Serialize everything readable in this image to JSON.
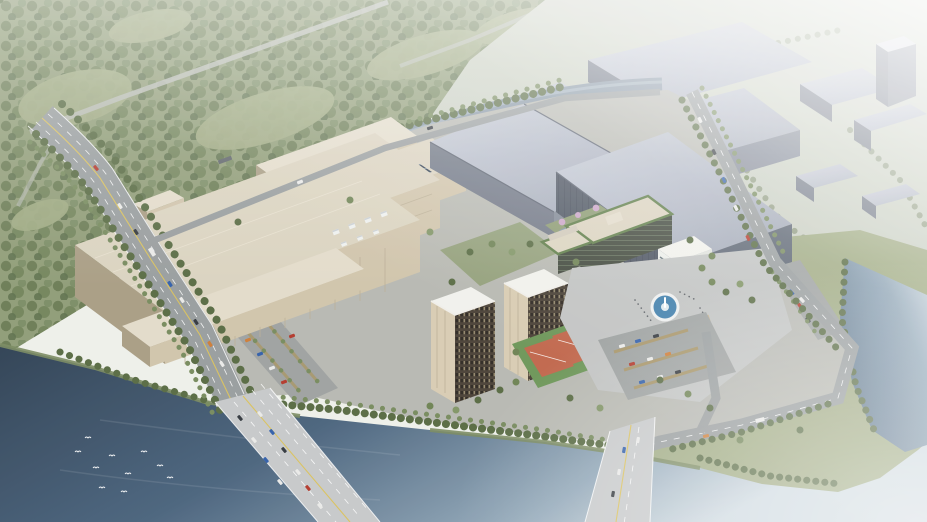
{
  "scene": {
    "type": "architectural-aerial-rendering",
    "description": "Bird's-eye daytime rendering of a riverside industrial / R&D campus: large beige fab halls with rooftop cooling units and solar panels, gray logistics warehouses, two brown dormitory towers, offices with green roof trim, a circular fountain plaza, basketball courts, tree-lined boulevard crossing a dark river on a wide bridge, forest and hazy industrial district in the background",
    "camera": "high oblique, looking north-east",
    "atmosphere": "strong white haze toward top-right, birds over water at lower-left"
  },
  "palette": {
    "sky": "#eef0e9",
    "haze": "#ffffff",
    "forest": "#8d9a74",
    "forest-dark": "#5e7048",
    "field": "#9ea980",
    "hazy-ground": "#c8cec0",
    "water-dark": "#2b3d50",
    "water-mid": "#46607a",
    "water-light": "#8fa5b6",
    "water-haze": "#cdd8df",
    "canal": "#8494a3",
    "road": "#969b9c",
    "road-faint": "#b7bbb4",
    "bridge-deck": "#c6c8c9",
    "lane-yellow": "#d9c05a",
    "campus-ground": "#b6b7b0",
    "plaza": "#c1c3c2",
    "parking": "#9ca09f",
    "beige-roof": "#dad2be",
    "beige-roof-light": "#e2dbc9",
    "beige-wall": "#cfc3a9",
    "beige-shadow": "#a79b81",
    "steel-roof": "#c4c9d5",
    "steel-roof-dark": "#9ca3b2",
    "steel-wall": "#6e7583",
    "steel-end": "#7e8593",
    "dark-wall": "#49515e",
    "dark-end": "#596270",
    "dorm-facade": "#473e33",
    "dorm-end": "#d7cbb1",
    "office-glass": "#3d4438",
    "green-roof": "#5b7a44",
    "white-building": "#eceee9",
    "white-roof": "#f1f1ec",
    "glass-band": "#4b5a64",
    "gym-glass": "#41565f",
    "court-orange": "#bf6448",
    "court-green": "#6a9455",
    "fountain-blue": "#3e7dab",
    "blossom": "#c9a3c6",
    "tree": "#55683f",
    "tree-light": "#74885a",
    "bank-green": "#77875d",
    "solar-panel": "#2c3b4e",
    "equipment": "#5a6066",
    "car-white": "#e9e9e7",
    "car-dark": "#2f343a",
    "car-red": "#b23527",
    "car-blue": "#2e5ca8"
  },
  "inventory": {
    "waterways": [
      "river",
      "river-east-arm",
      "canal"
    ],
    "crossings": [
      "main-bridge",
      "east-bridge"
    ],
    "buildings": [
      "fab-hall-front",
      "fab-hall-middle",
      "solar-fab",
      "north-warehouse",
      "gray-warehouse-nw",
      "dark-warehouse",
      "dormitory-tower-1",
      "dormitory-tower-2",
      "office-building",
      "white-office-cube",
      "white-culture-cube",
      "gym-building",
      "substation"
    ],
    "amenities": [
      "fountain-plaza",
      "basketball-courts",
      "blossom-garden",
      "parking-west",
      "parking-east",
      "parking-northeast"
    ],
    "background": [
      "forest",
      "hazy-industrial-district",
      "green-peninsula"
    ],
    "wildlife": [
      "birds-over-river"
    ]
  }
}
